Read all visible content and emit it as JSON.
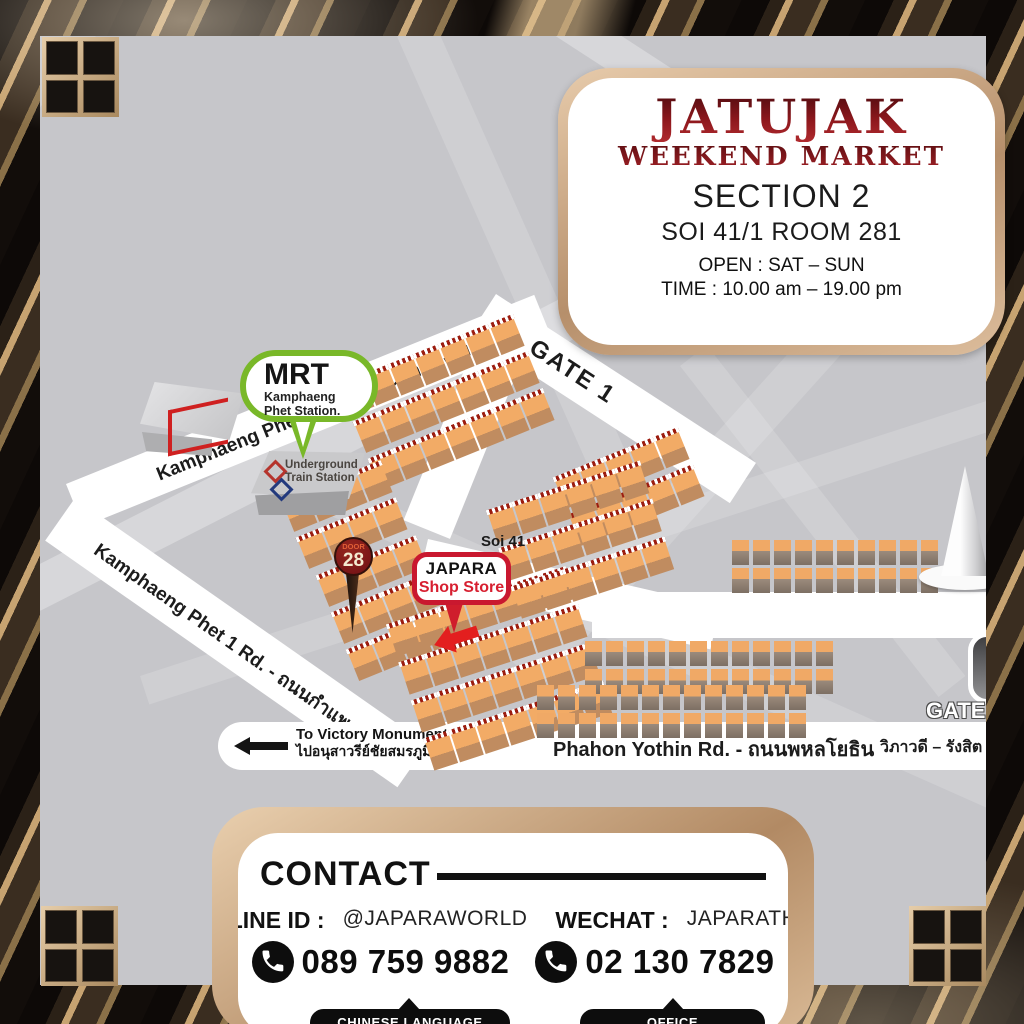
{
  "title_card": {
    "brand_line1": "JATUJAK",
    "brand_line2": "WEEKEND MARKET",
    "section": "SECTION 2",
    "address": "SOI 41/1 ROOM 281",
    "open": "OPEN : SAT – SUN",
    "time": "TIME : 10.00 am – 19.00 pm"
  },
  "map": {
    "mrt_station": {
      "title": "MRT",
      "subtitle": "Kamphaeng Phet Station."
    },
    "underground_station": {
      "line1": "Underground",
      "line2": "Train Station"
    },
    "door_marker": {
      "label": "DOOR",
      "number": "28"
    },
    "shop_marker": {
      "name": "JAPARA",
      "type": "Shop Store"
    },
    "roads": {
      "kamphaeng_phet_2": "Kamphaeng Phet 2 Rd. - ถนนกำแพงเพชร 2",
      "gate_1": "GATE 1",
      "soi_41": "Soi 41",
      "kamphaeng_phet_1": "Kamphaeng Phet 1 Rd. - ถนนกำแพงเพชร 1",
      "phahon_yothin": "Phahon Yothin Rd. - ถนนพหลโยธิน",
      "to_victory_line1": "To Victory Monument",
      "to_victory_line2": "ไปอนุสาวรีย์ชัยสมรภูมิ",
      "vibhavadi_rangsit": "วิภาวดี – รังสิต",
      "gate_3": "GATE 3"
    }
  },
  "contact_card": {
    "title": "CONTACT",
    "line_id_label": "LINE ID :",
    "line_id_value": "@JAPARAWORLD",
    "wechat_label": "WECHAT :",
    "wechat_value": "JAPARATH",
    "phone_chinese": "089 759 9882",
    "phone_chinese_tag": "CHINESE LANGUAGE",
    "phone_office": "02 130 7829",
    "phone_office_tag": "OFFICE"
  },
  "colors": {
    "brand_red": "#8a1418",
    "accent_red": "#d0212f",
    "mrt_green": "#79b829",
    "stall_orange": "#efa763",
    "road_white": "#ffffff",
    "map_gray": "#c6c6ca",
    "frame_tan": "#c9a183",
    "pill_black": "#0d0d0d"
  }
}
